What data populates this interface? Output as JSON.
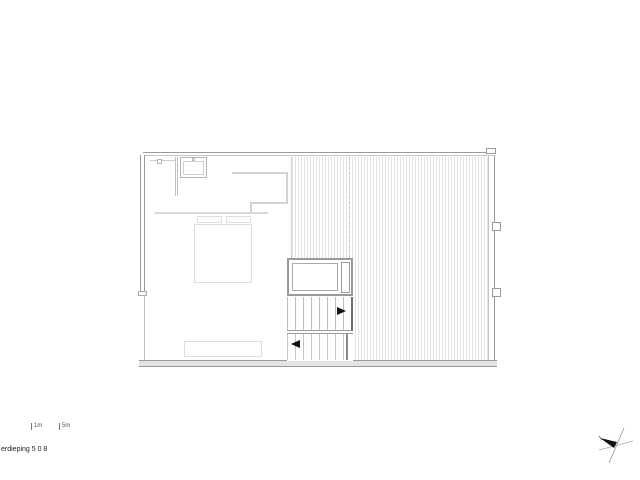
{
  "drawing": {
    "title": "erdieping 5 0 8",
    "scale_marks": [
      {
        "label": "1m"
      },
      {
        "label": "5m"
      }
    ]
  },
  "plan": {
    "areas": [
      {
        "name": "bedroom",
        "features": [
          "bed",
          "pillows",
          "headboard-shelf",
          "closet-partition",
          "roof-window",
          "low-cabinet"
        ]
      },
      {
        "name": "roof-terrace",
        "features": [
          "timber-decking-hatch",
          "gutter-dashed-line"
        ]
      },
      {
        "name": "stair-core",
        "features": [
          "lift-shaft",
          "upper-stair-flight",
          "lower-stair-flight",
          "direction-arrows"
        ]
      }
    ]
  },
  "icons": {
    "north_arrow": "north-arrow",
    "stair_up_arrow": "right-arrow",
    "stair_down_arrow": "left-arrow"
  },
  "colors": {
    "background": "#ffffff",
    "wall_line": "#9a9a9a",
    "furniture_line": "#dedede",
    "hatch_line": "#e3e3e3",
    "stair_edge_dark": "#6e6e6e",
    "arrow_black": "#111111",
    "text": "#222222"
  }
}
